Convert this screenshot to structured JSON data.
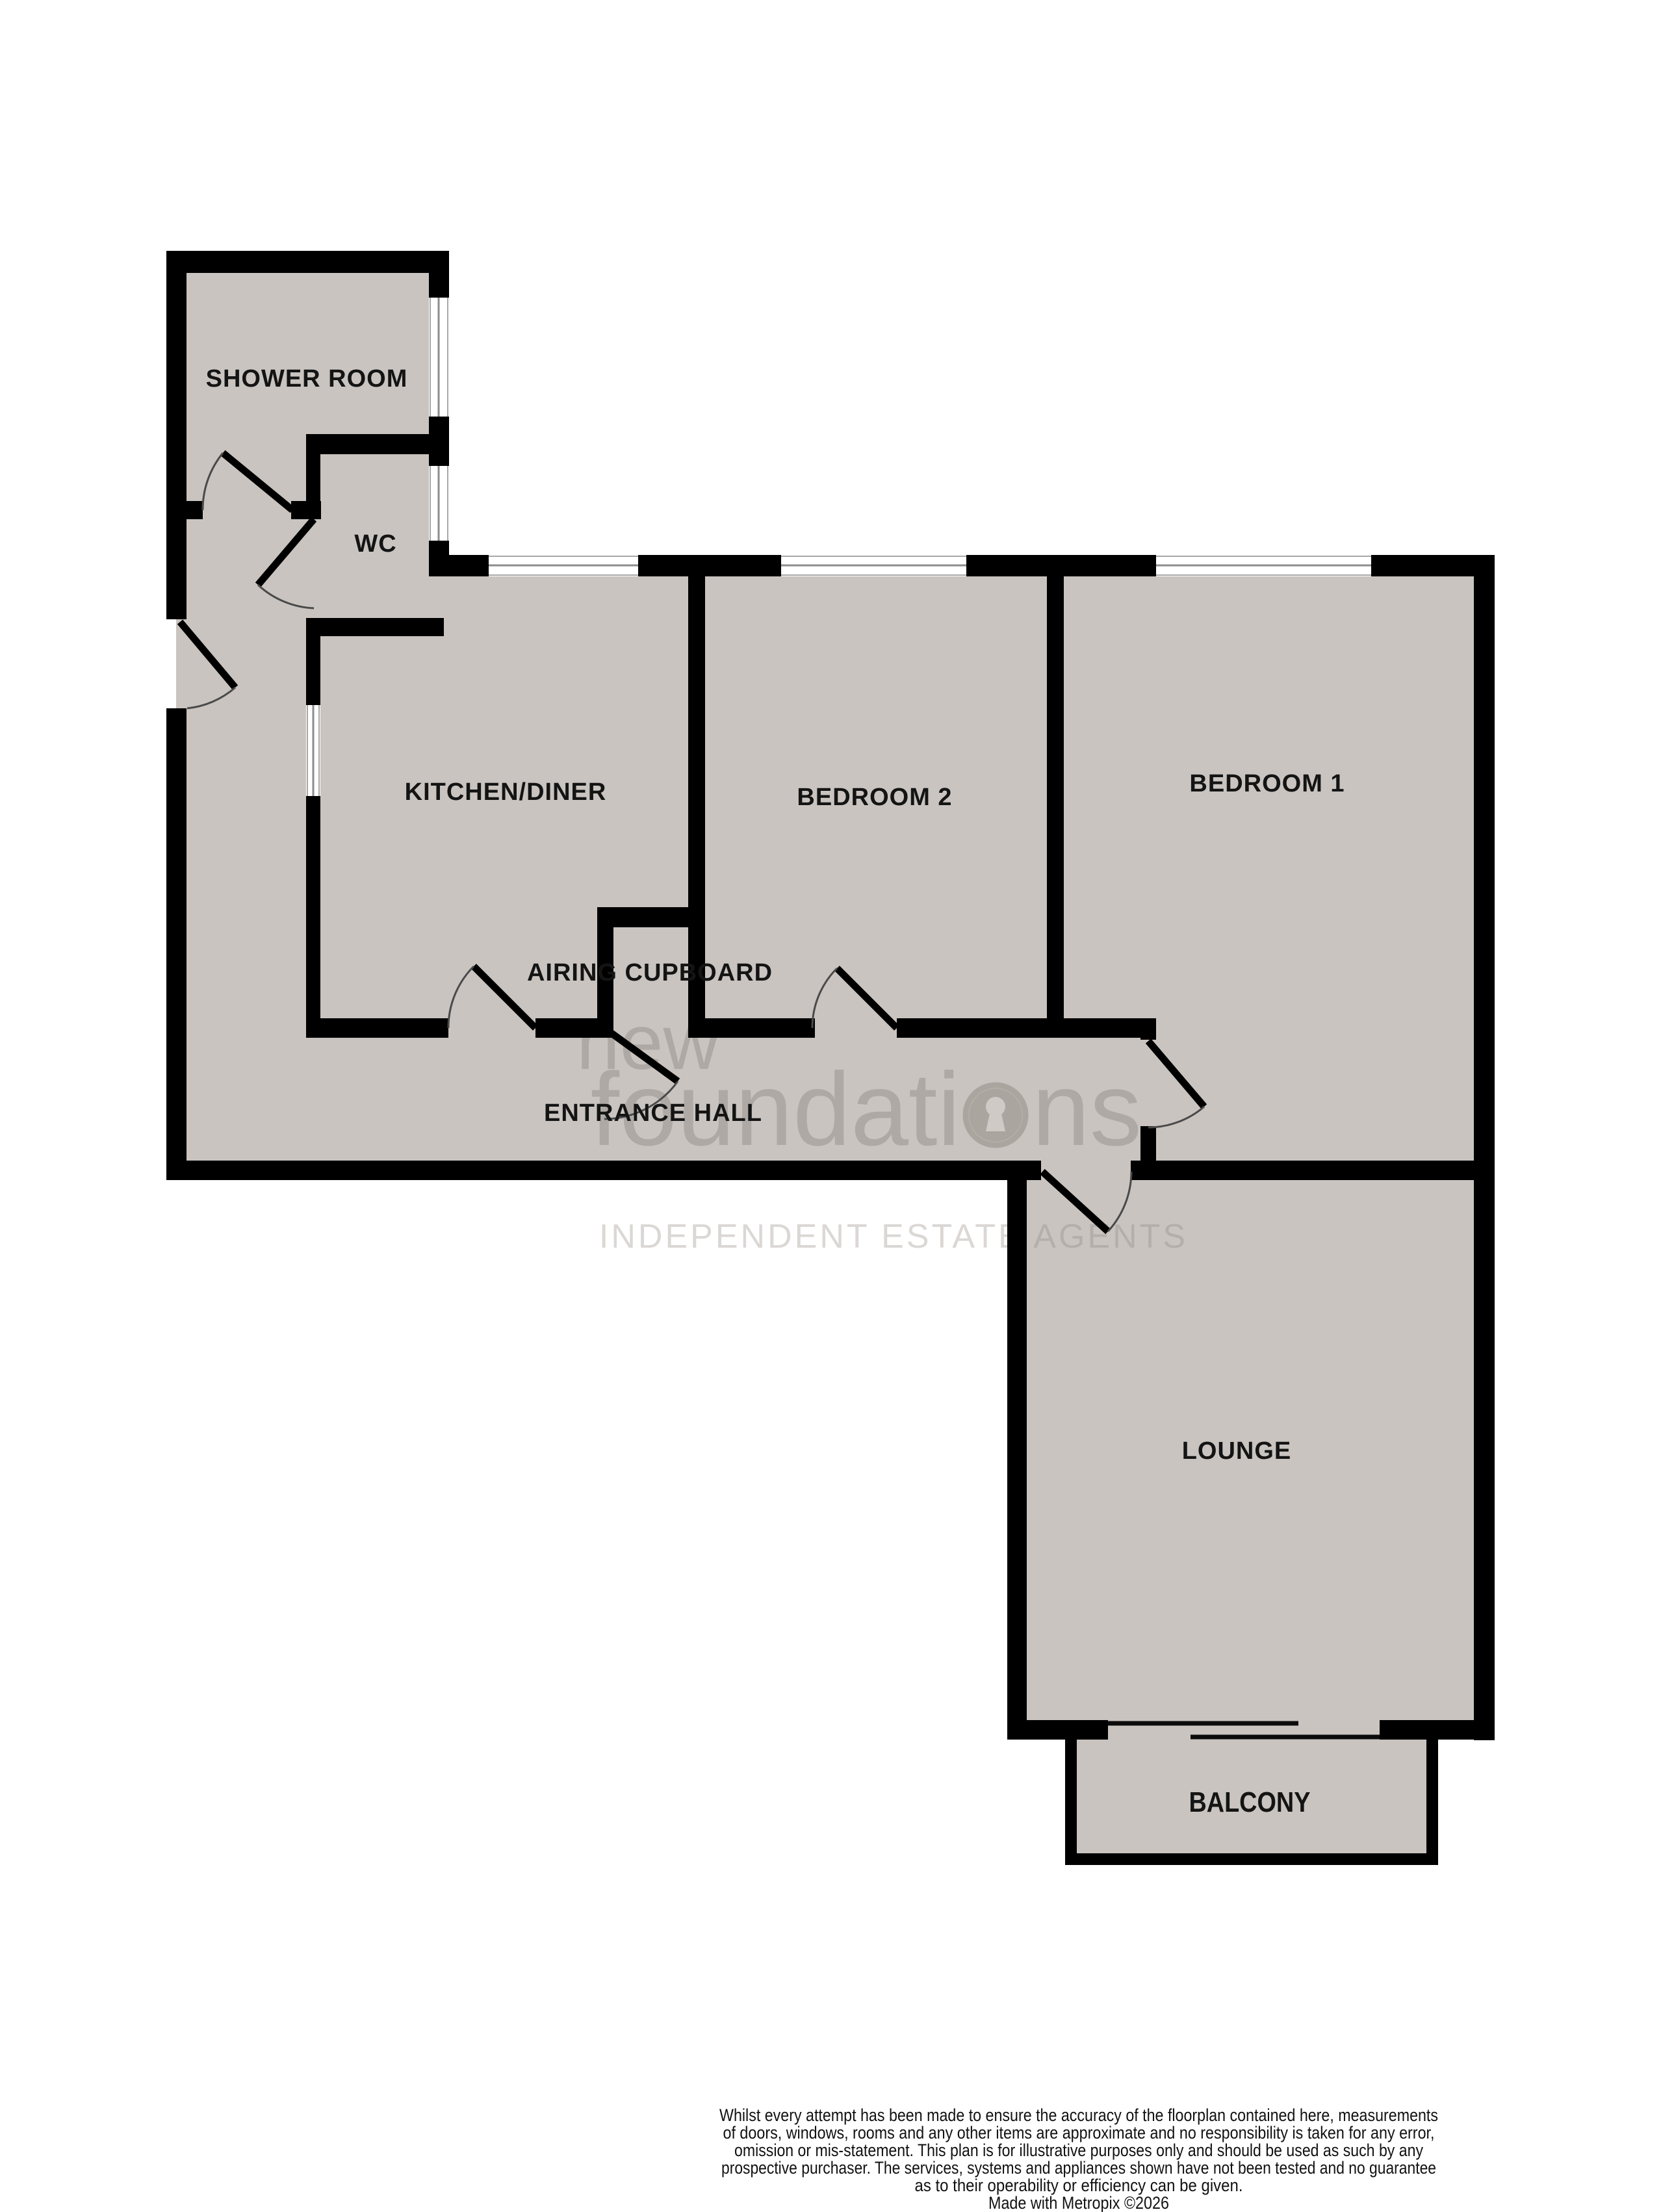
{
  "floorplan": {
    "rooms": [
      {
        "label": "SHOWER ROOM"
      },
      {
        "label": "WC"
      },
      {
        "label": "KITCHEN/DINER"
      },
      {
        "label": "BEDROOM 2"
      },
      {
        "label": "BEDROOM 1"
      },
      {
        "label": "AIRING CUPBOARD"
      },
      {
        "label": "ENTRANCE HALL"
      },
      {
        "label": "LOUNGE"
      },
      {
        "label": "BALCONY"
      }
    ],
    "colors": {
      "wall": "#000000",
      "floor": "#c9c4c0",
      "background": "#ffffff",
      "watermark": "#8d8680"
    },
    "watermark": {
      "line1": "new",
      "line2_pre": "foundati",
      "line2_post": "ns",
      "line3": "INDEPENDENT ESTATE AGENTS"
    }
  },
  "footer": {
    "disclaimer_lines": [
      "Whilst every attempt has been made to ensure the accuracy of the floorplan contained here, measurements",
      "of doors, windows, rooms and any other items are approximate and no responsibility is taken for any error,",
      "omission or mis-statement. This plan is for illustrative purposes only and should be used as such by any",
      "prospective purchaser. The services, systems and appliances shown have not been tested and no guarantee",
      "as to their operability or efficiency can be given."
    ],
    "credit": "Made with Metropix ©2026"
  }
}
